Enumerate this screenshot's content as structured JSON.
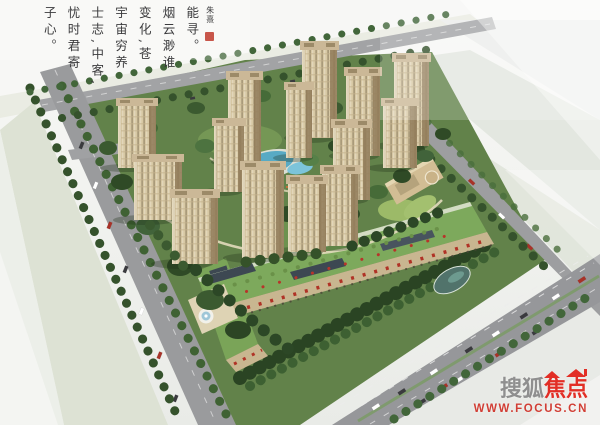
{
  "calligraphy": {
    "columns": [
      "能寻。",
      "烟云渺谁",
      "变化,苍",
      "宇宙穷养",
      "士志,中客,",
      "忧时君寄",
      "子心。"
    ],
    "signature": "朱熹",
    "ink_color": "#3b3b3d",
    "seal_color": "#c0392b"
  },
  "watermark": {
    "brand_first": "搜狐",
    "brand_second": "焦点",
    "url": "WWW.FOCUS.CN",
    "first_color": "#8a8a8a",
    "second_color": "#e2231a"
  },
  "scene": {
    "palette": {
      "tower_face": "#d7c8a4",
      "tower_shade": "#8f7a58",
      "foliage_dark": "#2f4a27",
      "foliage_mid": "#4d6f3a",
      "roof_garden_green": "#7aa458",
      "pool_water": "#58aac4",
      "road_gray": "#98999b",
      "ground_band_sage": "#dde2d4"
    }
  }
}
